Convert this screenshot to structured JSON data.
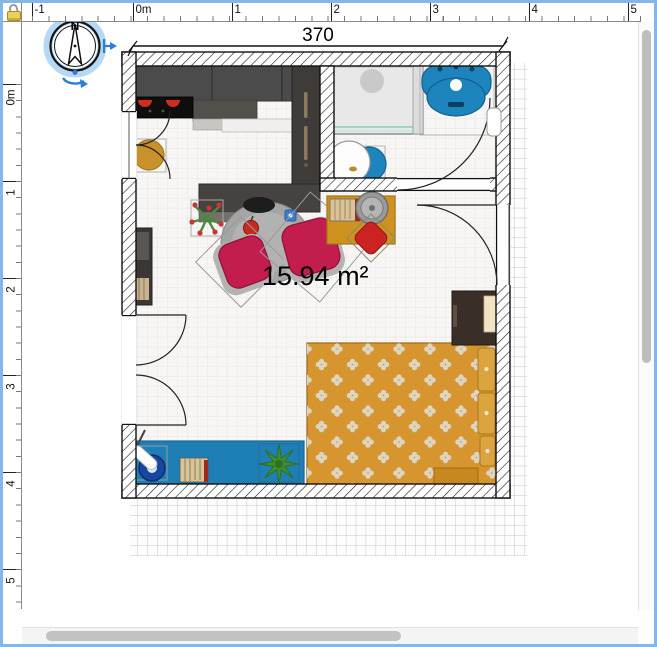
{
  "window": {
    "title": "floor-plan-editor",
    "border_color": "#84b6e8",
    "corner_icon": "lock-icon"
  },
  "rulers": {
    "unit": "m",
    "top": {
      "labels": [
        "-1",
        "0m",
        "1",
        "2",
        "3",
        "4",
        "5"
      ]
    },
    "left": {
      "labels": [
        "0m",
        "1",
        "2",
        "3",
        "4",
        "5"
      ]
    }
  },
  "plan": {
    "dimension_label": "370",
    "dimension_value_cm": 370,
    "area_label": "15.94 m²",
    "area_value_m2": 15.94,
    "compass": {
      "north_label": "N",
      "selected": true
    },
    "rooms": [
      "main-room",
      "bathroom"
    ],
    "furniture": {
      "kitchen": [
        "wall-cabinets",
        "cooktop",
        "countertop",
        "refrigerator",
        "bar-counter",
        "stool"
      ],
      "living": [
        "bookshelf",
        "flower-pot",
        "round-table",
        "red-armchair",
        "red-armchair",
        "apple",
        "side-table",
        "grill",
        "red-chair"
      ],
      "bathroom": [
        "shower",
        "washbasin",
        "toilet",
        "wall-niche"
      ],
      "bedroom": [
        "double-bed",
        "pillows",
        "bedside-cabinet"
      ],
      "office": [
        "blue-desk",
        "desk-lamp",
        "books",
        "houseplant"
      ],
      "openings": [
        "entrance-door",
        "bathroom-door",
        "casement-window",
        "french-doors"
      ]
    }
  },
  "colors": {
    "selection_highlight": "#b5d9f4",
    "handle_blue": "#2b7fd4",
    "wall_outline": "#111111",
    "bed_orange": "#d6952f",
    "desk_blue": "#1d7fb5",
    "chair_red": "#c21d4d",
    "sink_blue": "#1d84bd",
    "cabinet_dark": "#4b4b4b",
    "stool_gold": "#c8912b",
    "grid_line": "#c7c7c7"
  }
}
